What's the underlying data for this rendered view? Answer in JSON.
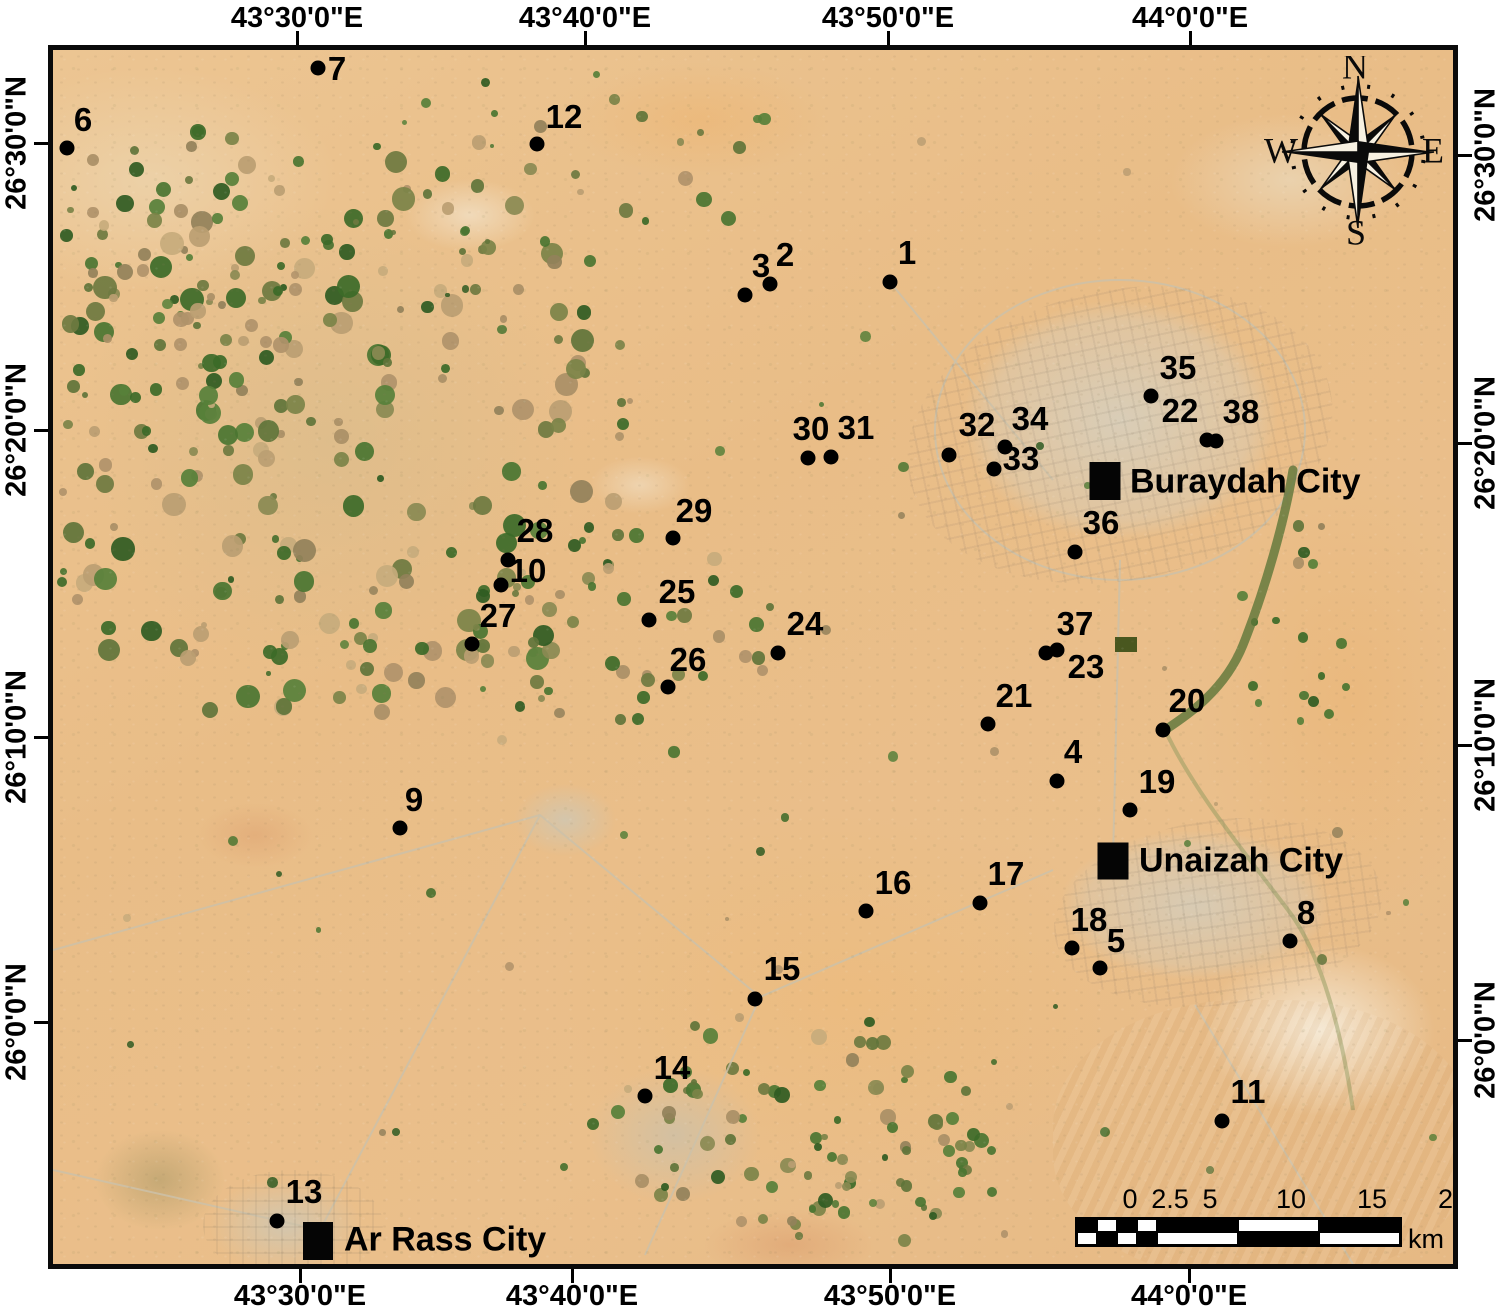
{
  "figure": {
    "width": 1500,
    "height": 1311,
    "frame": {
      "left": 48,
      "top": 45,
      "border": 5,
      "width": 1410,
      "height": 1224,
      "border_color": "#0a0a0a"
    },
    "colors": {
      "sand_base": "#e9c08b",
      "urban": "#d6c9ae",
      "dot": "#000000",
      "label": "#000000",
      "field_green": "#3c6a28",
      "field_olive": "#7b8348",
      "field_brown": "#bb9e72",
      "wadi_green": "#5d7638",
      "field_square_green": "#49571f",
      "white_flat": "#f6efe0"
    },
    "axis": {
      "top": [
        {
          "label": "43°30'0\"E",
          "pos": 297
        },
        {
          "label": "43°40'0\"E",
          "pos": 585
        },
        {
          "label": "43°50'0\"E",
          "pos": 888
        },
        {
          "label": "44°0'0\"E",
          "pos": 1190
        }
      ],
      "bottom": [
        {
          "label": "43°30'0\"E",
          "pos": 300
        },
        {
          "label": "43°40'0\"E",
          "pos": 572
        },
        {
          "label": "43°50'0\"E",
          "pos": 890
        },
        {
          "label": "44°0'0\"E",
          "pos": 1189
        }
      ],
      "left": [
        {
          "label": "26°30'0\"N",
          "pos": 143
        },
        {
          "label": "26°20'0\"N",
          "pos": 430
        },
        {
          "label": "26°10'0\"N",
          "pos": 737
        },
        {
          "label": "26°0'0\"N",
          "pos": 1022
        }
      ],
      "right": [
        {
          "label": "26°30'0\"N",
          "pos": 155
        },
        {
          "label": "26°20'0\"N",
          "pos": 443
        },
        {
          "label": "26°10'0\"N",
          "pos": 745
        },
        {
          "label": "26°0'0\"N",
          "pos": 1040
        }
      ]
    },
    "sites": [
      {
        "id": "1",
        "x": 890,
        "y": 282,
        "lx": 907,
        "ly": 253
      },
      {
        "id": "2",
        "x": 770,
        "y": 284,
        "lx": 785,
        "ly": 255
      },
      {
        "id": "3",
        "x": 745,
        "y": 295,
        "lx": 761,
        "ly": 266
      },
      {
        "id": "4",
        "x": 1057,
        "y": 781,
        "lx": 1073,
        "ly": 752
      },
      {
        "id": "5",
        "x": 1100,
        "y": 968,
        "lx": 1116,
        "ly": 941
      },
      {
        "id": "6",
        "x": 67,
        "y": 148,
        "lx": 83,
        "ly": 120
      },
      {
        "id": "7",
        "x": 318,
        "y": 68,
        "lx": 337,
        "ly": 69
      },
      {
        "id": "8",
        "x": 1290,
        "y": 941,
        "lx": 1306,
        "ly": 913
      },
      {
        "id": "9",
        "x": 400,
        "y": 828,
        "lx": 414,
        "ly": 800
      },
      {
        "id": "10",
        "x": 501,
        "y": 585,
        "lx": 528,
        "ly": 571
      },
      {
        "id": "11",
        "x": 1222,
        "y": 1121,
        "lx": 1248,
        "ly": 1092
      },
      {
        "id": "12",
        "x": 537,
        "y": 144,
        "lx": 564,
        "ly": 117
      },
      {
        "id": "13",
        "x": 277,
        "y": 1221,
        "lx": 304,
        "ly": 1192
      },
      {
        "id": "14",
        "x": 645,
        "y": 1096,
        "lx": 672,
        "ly": 1068
      },
      {
        "id": "15",
        "x": 755,
        "y": 999,
        "lx": 782,
        "ly": 969
      },
      {
        "id": "16",
        "x": 866,
        "y": 911,
        "lx": 893,
        "ly": 883
      },
      {
        "id": "17",
        "x": 980,
        "y": 903,
        "lx": 1006,
        "ly": 874
      },
      {
        "id": "18",
        "x": 1072,
        "y": 948,
        "lx": 1089,
        "ly": 920
      },
      {
        "id": "19",
        "x": 1130,
        "y": 810,
        "lx": 1157,
        "ly": 782
      },
      {
        "id": "20",
        "x": 1163,
        "y": 730,
        "lx": 1187,
        "ly": 701
      },
      {
        "id": "21",
        "x": 988,
        "y": 724,
        "lx": 1014,
        "ly": 696
      },
      {
        "id": "22",
        "x": 1207,
        "y": 440,
        "lx": 1180,
        "ly": 411
      },
      {
        "id": "23",
        "x": 1046,
        "y": 653,
        "lx": 1086,
        "ly": 667
      },
      {
        "id": "24",
        "x": 778,
        "y": 653,
        "lx": 805,
        "ly": 624
      },
      {
        "id": "25",
        "x": 649,
        "y": 620,
        "lx": 677,
        "ly": 592
      },
      {
        "id": "26",
        "x": 668,
        "y": 687,
        "lx": 688,
        "ly": 660
      },
      {
        "id": "27",
        "x": 472,
        "y": 644,
        "lx": 498,
        "ly": 616
      },
      {
        "id": "28",
        "x": 508,
        "y": 560,
        "lx": 535,
        "ly": 531
      },
      {
        "id": "29",
        "x": 673,
        "y": 538,
        "lx": 694,
        "ly": 511
      },
      {
        "id": "30",
        "x": 808,
        "y": 458,
        "lx": 811,
        "ly": 429
      },
      {
        "id": "31",
        "x": 831,
        "y": 457,
        "lx": 856,
        "ly": 428
      },
      {
        "id": "32",
        "x": 949,
        "y": 455,
        "lx": 977,
        "ly": 425
      },
      {
        "id": "33",
        "x": 994,
        "y": 469,
        "lx": 1021,
        "ly": 459
      },
      {
        "id": "34",
        "x": 1005,
        "y": 447,
        "lx": 1030,
        "ly": 419
      },
      {
        "id": "35",
        "x": 1151,
        "y": 396,
        "lx": 1178,
        "ly": 368
      },
      {
        "id": "36",
        "x": 1075,
        "y": 552,
        "lx": 1101,
        "ly": 523
      },
      {
        "id": "37",
        "x": 1057,
        "y": 650,
        "lx": 1075,
        "ly": 624
      },
      {
        "id": "38",
        "x": 1216,
        "y": 441,
        "lx": 1241,
        "ly": 412
      }
    ],
    "cities": [
      {
        "name": "Buraydah City",
        "sx": 1105,
        "sy": 481,
        "sw": 31,
        "sh": 38,
        "lx": 1130,
        "ly": 482
      },
      {
        "name": "Unaizah City",
        "sx": 1113,
        "sy": 861,
        "sw": 31,
        "sh": 37,
        "lx": 1139,
        "ly": 861
      },
      {
        "name": "Ar Rass City",
        "sx": 318,
        "sy": 1241,
        "sw": 30,
        "sh": 38,
        "lx": 344,
        "ly": 1240
      }
    ],
    "compass": {
      "cx": 1358,
      "cy": 152,
      "letters": {
        "n": "N",
        "e": "E",
        "s": "S",
        "w": "W"
      }
    },
    "scalebar": {
      "tick_labels": [
        "0",
        "2.5",
        "5",
        "10",
        "15",
        "20"
      ],
      "tick_x": [
        1077,
        1117,
        1157,
        1238,
        1319,
        1400
      ],
      "unit": "km",
      "x": 1077,
      "y": 1217,
      "height": 26,
      "cells": [
        20,
        20,
        20,
        20,
        81,
        81,
        81
      ]
    },
    "field_square": {
      "x": 1115,
      "y": 637,
      "w": 22,
      "h": 15
    }
  }
}
